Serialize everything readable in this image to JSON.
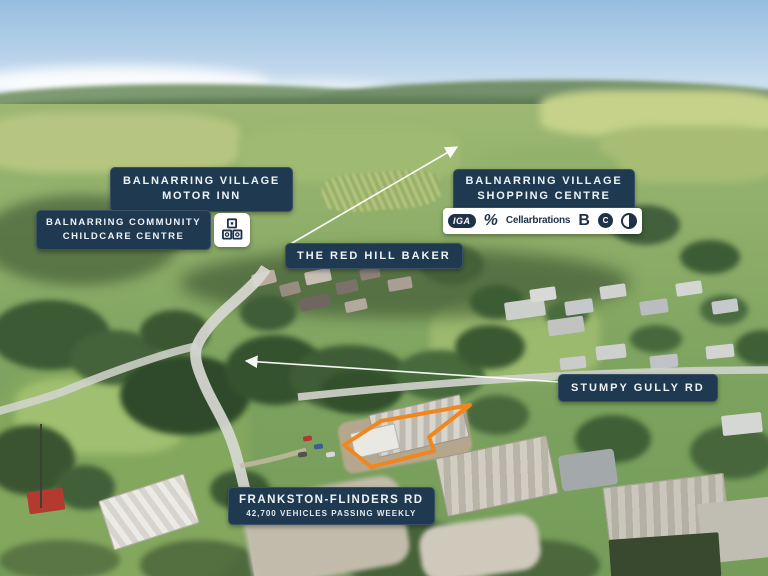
{
  "annotations": {
    "motor_inn": {
      "line1": "BALNARRING VILLAGE",
      "line2": "MOTOR INN"
    },
    "childcare": {
      "line1": "BALNARRING COMMUNITY",
      "line2": "CHILDCARE CENTRE",
      "icon": "toy-blocks-icon"
    },
    "shopping_centre": {
      "line1": "BALNARRING VILLAGE",
      "line2": "SHOPPING CENTRE",
      "logos": {
        "iga": "IGA",
        "percent_mark": "%",
        "cellarbrations": "Cellarbrations",
        "b_mark": "B"
      }
    },
    "baker": {
      "text": "THE RED HILL BAKER"
    },
    "stumpy_gully": {
      "text": "STUMPY GULLY RD"
    },
    "frankston_flinders": {
      "line1": "FRANKSTON-FLINDERS RD",
      "line2": "42,700 VEHICLES PASSING WEEKLY"
    }
  },
  "colors": {
    "label_background": "#1f3950",
    "label_text": "#eef3f6",
    "property_highlight": "#f0861e",
    "logo_navy": "#1d3249",
    "arrow": "#ffffff"
  }
}
